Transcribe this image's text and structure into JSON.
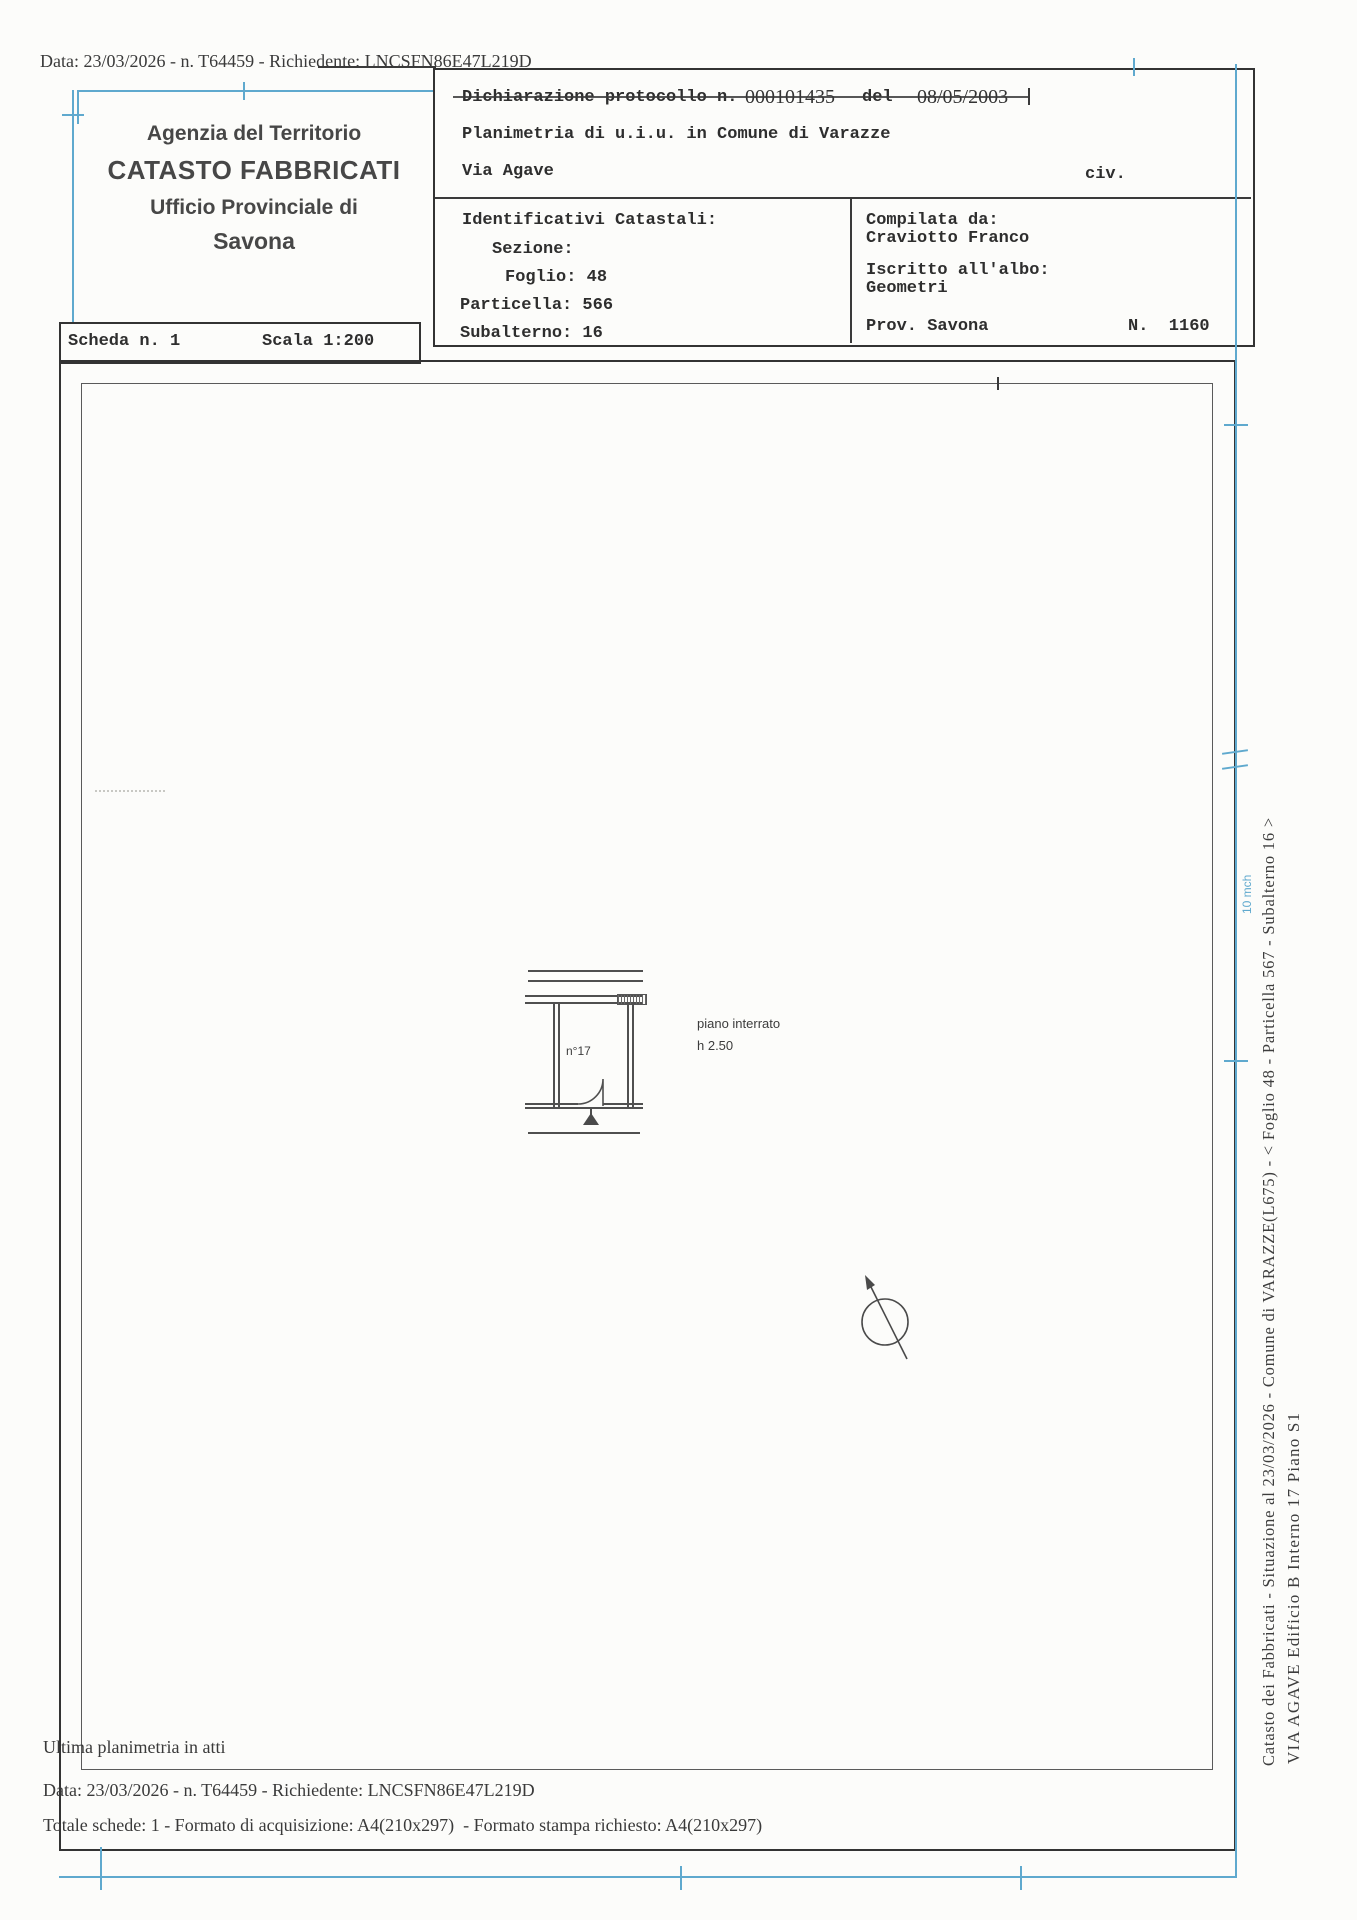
{
  "scan": {
    "top_line": "Data: 23/03/2026 - n. T64459 - Richiedente: LNCSFN86E47L219D",
    "ultima": "Ultima planimetria in atti",
    "bottom_data": "Data: 23/03/2026 - n. T64459 - Richiedente: LNCSFN86E47L219D",
    "bottom_total": "Totale schede: 1 - Formato di acquisizione: A4(210x297)  - Formato stampa richiesto: A4(210x297)"
  },
  "agency": {
    "line1": "Agenzia del Territorio",
    "line2": "CATASTO FABBRICATI",
    "line3": "Ufficio Provinciale di",
    "line4": "Savona"
  },
  "declaration": {
    "label": "Dichiarazione protocollo n.",
    "protocol_number": "000101435",
    "del_label": "del",
    "date": "08/05/2003",
    "planimetria": "Planimetria di u.i.u. in Comune di Varazze",
    "street": "Via Agave",
    "civ": "civ."
  },
  "identifiers": {
    "title": "Identificativi Catastali:",
    "sezione": "Sezione:",
    "foglio": "Foglio: 48",
    "particella": "Particella: 566",
    "subalterno": "Subalterno: 16"
  },
  "compiler": {
    "compilata": "Compilata da:",
    "name": "Craviotto Franco",
    "iscritto": "Iscritto all'albo:",
    "albo": "Geometri",
    "prov": "Prov. Savona",
    "number": "N.  1160"
  },
  "scheda": {
    "scheda": "Scheda n. 1",
    "scala": "Scala 1:200"
  },
  "plan": {
    "room_label": "n°17",
    "floor_label": "piano interrato",
    "height_label": "h 2.50"
  },
  "margin": {
    "line1": "Catasto dei Fabbricati - Situazione al 23/03/2026 - Comune di VARAZZE(L675) - < Foglio 48 - Particella 567 - Subalterno 16 >",
    "line2": "VIA AGAVE  Edificio B Interno 17 Piano S1",
    "blue_note": "10 mch"
  },
  "colors": {
    "registration_blue": "#5fa9ce",
    "ink": "#2e2e2e",
    "stamp_ink": "#333333"
  }
}
